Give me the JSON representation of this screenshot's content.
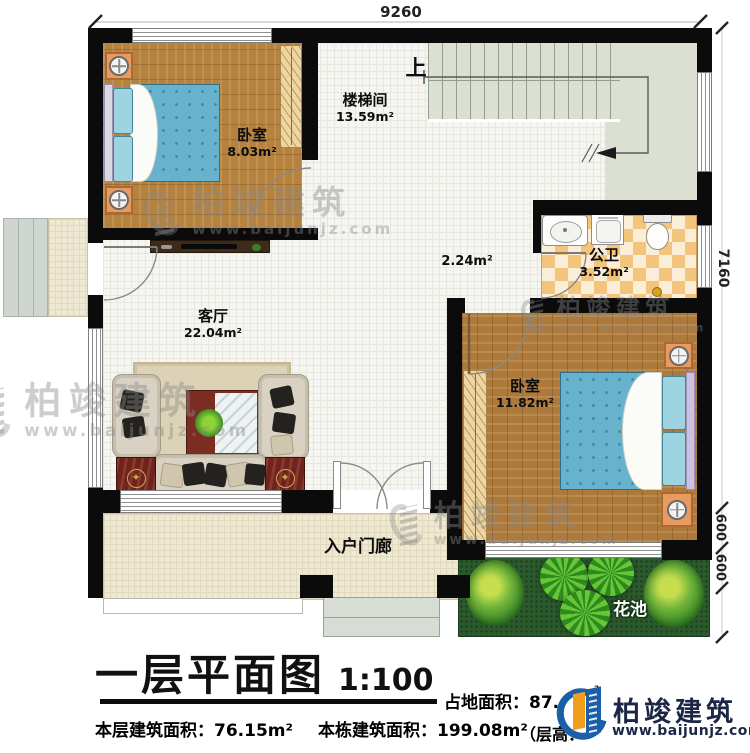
{
  "plan": {
    "rooms": {
      "bedroom1": {
        "name": "卧室",
        "area": "8.03m²"
      },
      "stairwell": {
        "name": "楼梯间",
        "area": "13.59m²"
      },
      "bathroom": {
        "name": "公卫",
        "area": "3.52m²"
      },
      "living_room": {
        "name": "客厅",
        "area": "22.04m²"
      },
      "bedroom2": {
        "name": "卧室",
        "area": "11.82m²"
      },
      "hallway": {
        "area": "2.24m²"
      },
      "porch": {
        "name": "入户门廊"
      },
      "flower_bed": {
        "name": "花池"
      }
    },
    "stairs": {
      "direction_label": "上"
    },
    "dimensions": {
      "top_width": "9260",
      "right_height": "7160",
      "right_seg_a": "600",
      "right_seg_b": "600"
    }
  },
  "footer": {
    "title": "一层平面图",
    "scale": "1:100",
    "land_area_visible": "占地面积：87.",
    "land_area_superscript": "²",
    "floor_area": "本层建筑面积：76.15m²",
    "building_area": "本栋建筑面积：199.08m²",
    "obscured_fragment": "（层高："
  },
  "brand": {
    "name": "柏竣建筑",
    "website": "www.baijunjz.com"
  },
  "watermark": {
    "name": "柏竣建筑",
    "website": "www.baijunjz.com"
  },
  "colors": {
    "wall": "#0b0b0b",
    "wood": "#b5823f",
    "bed_blue": "#67b3cd",
    "stair_floor": "#dbe0d3",
    "bath_tile_a": "#f2c47c",
    "bath_tile_b": "#faeed8",
    "porch": "#efe9d3",
    "lawn": "#2b5a2c",
    "brand_blue": "#1a5fa8",
    "brand_orange": "#f39d1d",
    "brand_text": "#1c2746"
  }
}
